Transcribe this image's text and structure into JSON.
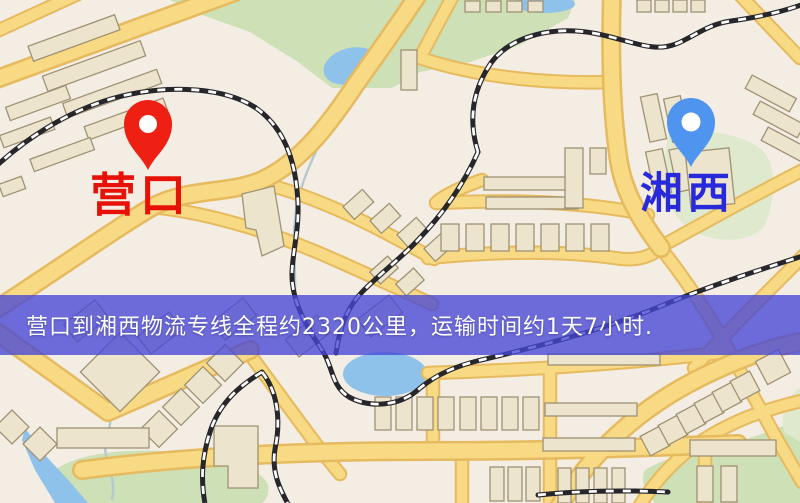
{
  "map": {
    "markers": [
      {
        "id": "origin",
        "label": "营口",
        "pin_color": "#ee1f13",
        "label_color": "#e81107"
      },
      {
        "id": "destination",
        "label": "湘西",
        "pin_color": "#4f95ef",
        "label_color": "#2929dc"
      }
    ]
  },
  "banner": {
    "text": "营口到湘西物流专线全程约2320公里，运输时间约1天7小时.",
    "background": "rgba(71,70,214,0.78)",
    "text_color": "#ffffff"
  },
  "colors": {
    "map_background": "#f3ede3",
    "road_fill": "#f8da84",
    "road_casing": "#e6ba5e",
    "water": "#8fc2ea",
    "park": "#cde0b6",
    "building": "#ece4cc",
    "railway": "#26262b"
  }
}
